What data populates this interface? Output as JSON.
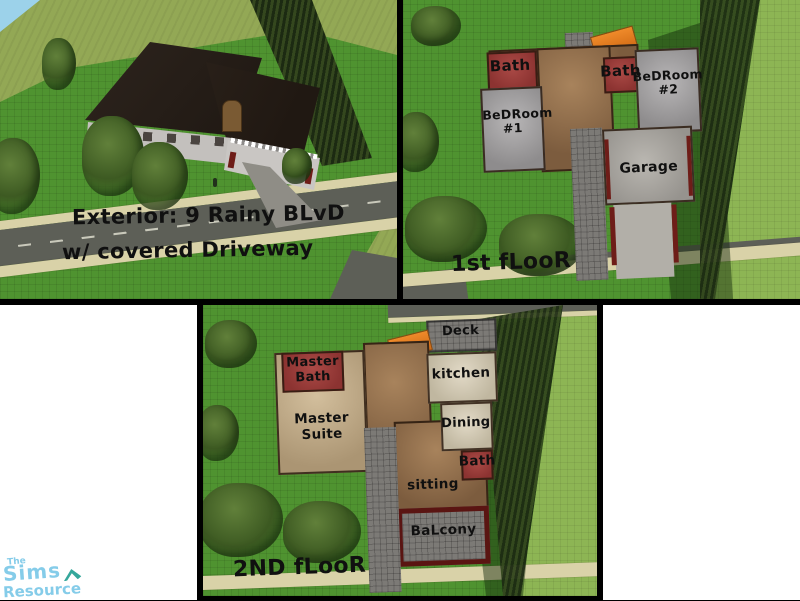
{
  "panels": {
    "exterior": {
      "caption_line1": "Exterior: 9 Rainy BLvD",
      "caption_line2": "w/ covered Driveway"
    },
    "floor1": {
      "label": "1st fLooR",
      "rooms": {
        "bath_upper": "Bath",
        "bedroom1": "BeDRoom #1",
        "bath_main": "Bath",
        "bedroom2": "BeDRoom #2",
        "garage": "Garage"
      }
    },
    "floor2": {
      "label": "2ND fLooR",
      "rooms": {
        "master_bath": "Master Bath",
        "master_suite": "Master Suite",
        "deck": "Deck",
        "kitchen": "kitchen",
        "dining": "Dining",
        "bath": "Bath",
        "sitting": "sitting",
        "balcony": "BaLcony"
      }
    }
  },
  "watermark": {
    "the": "The",
    "sims": "Sims",
    "resource": "Resource"
  },
  "colors": {
    "border_black": "#000000",
    "sky": "#9cd2ea",
    "hill_olive": "#93a855",
    "lawn_green": "#4f9330",
    "grass_light": "#8db554",
    "cliff_dark": "#24351a",
    "roof_dark": "#261e18",
    "wall_gray": "#c3c0bd",
    "road_gray": "#5d5f57",
    "sidewalk_tan": "#d9d2a8",
    "stone_path": "#7c7a76",
    "floor_brown": "#8d6b4a",
    "floor_tan": "#c2ae8c",
    "floor_light_tan": "#d8cfba",
    "bath_red": "#9a3f3b",
    "room_gray": "#a09e9f",
    "garage_concrete": "#aaa7a1",
    "awning_orange": "#e0791f",
    "balcony_trim": "#5a1512",
    "tree_green": "#3d5a22",
    "logo_blue": "#85cce9",
    "logo_teal": "#35a79b"
  }
}
